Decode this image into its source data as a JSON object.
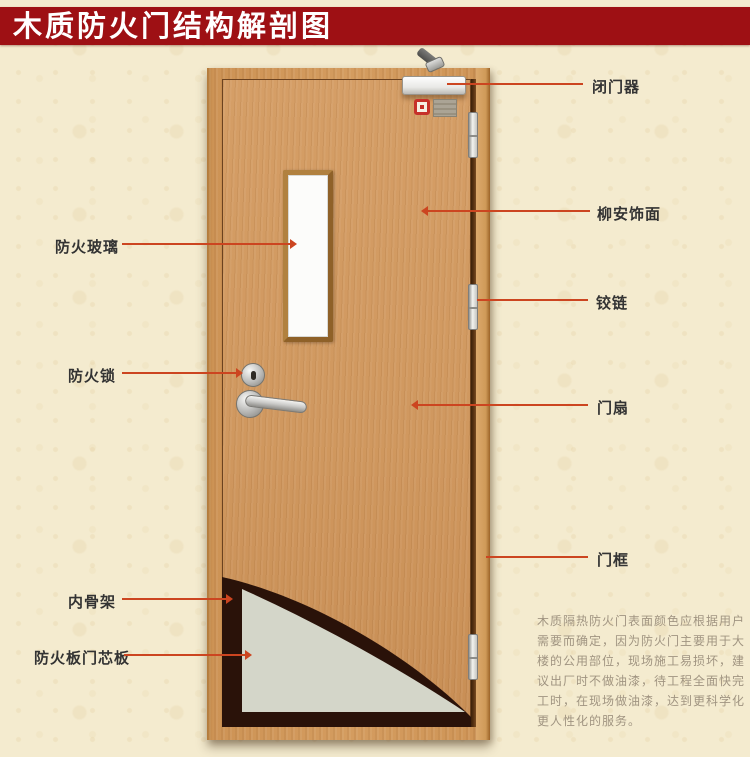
{
  "title": {
    "text": "木质防火门结构解剖图"
  },
  "callouts": {
    "left": [
      {
        "label": "防火玻璃"
      },
      {
        "label": "防火锁"
      },
      {
        "label": "内骨架"
      },
      {
        "label": "防火板门芯板"
      }
    ],
    "right": [
      {
        "label": "闭门器"
      },
      {
        "label": "柳安饰面"
      },
      {
        "label": "铰链"
      },
      {
        "label": "门扇"
      },
      {
        "label": "门框"
      }
    ]
  },
  "description": {
    "lines": [
      "木质隔热防火门表面颜色应根据用户",
      "需要而确定，因为防火门主要用于大",
      "楼的公用部位，现场施工易损坏，建",
      "议出厂时不做油漆，待工程全面快完",
      "工时，在现场做油漆，达到更科学化",
      "更人性化的服务。"
    ]
  },
  "colors": {
    "banner": "#9e1014",
    "leader_line": "#cc4520",
    "label_text": "#333333",
    "description_text": "#a09481",
    "door_wood": "#d0985f",
    "core_board": "#d4d6c9",
    "inner_skeleton": "#2a1209"
  }
}
